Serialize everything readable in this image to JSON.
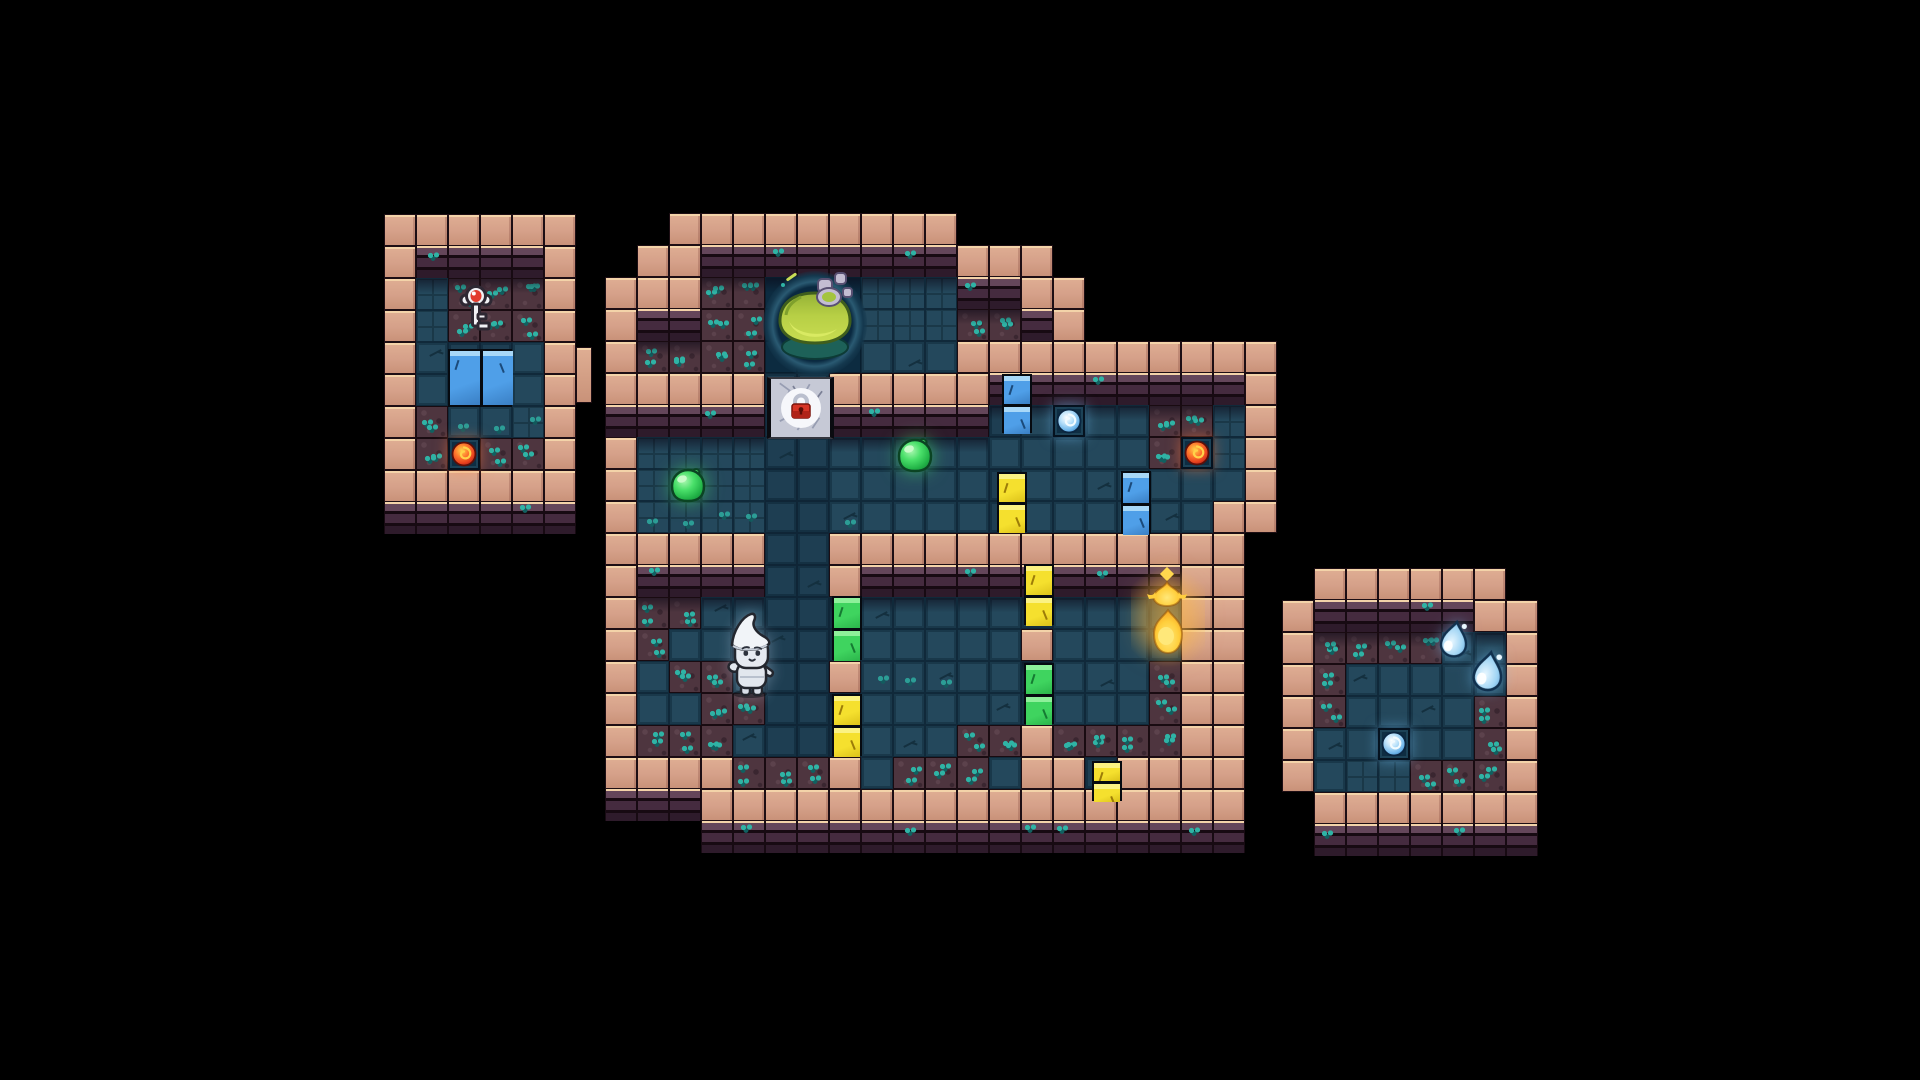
{
  "app": {
    "name": "pixel-dungeon-map",
    "view": "top-down dungeon floor on black void"
  },
  "scene": {
    "width": 1920,
    "height": 1080,
    "tile_size": 32,
    "background": "#000000",
    "palette": {
      "wall_pink": "#d5a089",
      "wall_pink_highlight": "#f3d3a9",
      "wall_seam": "#1d0e14",
      "brick_light": "#64465a",
      "brick_mid": "#452b3f",
      "brick_dark": "#2e1b2b",
      "brick_mortar": "#170a12",
      "floor": "#24485c",
      "floor_dark": "#1e3e52",
      "floor_line": "#1a3848",
      "dirt": "#4e353f",
      "moss": "#2fb3a5",
      "moss_dark": "#116060",
      "pit": "#0c2b40",
      "pit_ring": "#2a5a72",
      "goo": "#b7cf45",
      "goo_light": "#d9ea62",
      "goo_dark": "#3f5e1d",
      "slime_green": "#35d355",
      "orb_red": "#e8431f",
      "orb_blue": "#7cc3f0",
      "door_blue": "#4f9fe8",
      "door_yellow": "#f5e02e",
      "door_green": "#3fd45f",
      "stone_door": "#c6c9d6",
      "lock_red": "#d63426",
      "flame_gold": "#ffb12a",
      "water_blue": "#9fd4f4",
      "player_white": "#e8ecf2"
    },
    "legend": {
      "P": "pink-wall",
      "B": "brick-wall-face",
      "F": "floor-tile",
      "S": "floor-small-tiles",
      "f": "floor-dark",
      "D": "dirt-floor",
      "C": "pit-floor",
      ".": "void"
    },
    "structures": [
      {
        "id": "west-room",
        "origin": [
          384,
          214
        ],
        "rows": [
          "PPPPPP",
          "PBBBBP",
          "PSDDDP",
          "PSDDDP",
          "PFffFP",
          "PFffFP",
          "PDFFSP",
          "PDFDDP",
          "PPPPPP",
          "BBBBBB"
        ]
      },
      {
        "id": "main-dungeon",
        "origin": [
          605,
          213
        ],
        "rows": [
          "..PPPPPPPPP..........",
          ".PPBBBBBBBBPPP.......",
          "PPPDDCCCSSSBBPP......",
          "PBBDDCCCSSSDDBP......",
          "PDDDDCCCFFFPPPPPPPPPP",
          "PPPPPffPPPPPBBBBBBBBP",
          "BBBBBffBBBBBfFFFFDDSP",
          "PSSSSffFFFFFFFFFFDFSP",
          "PSSSSffFFFFFfFFFFFFFP",
          "PSSSSffFFFFFfFFFFFFPP",
          "PPPPPffPPPPPPPPPPPPP.",
          "PBBBBffPBBBBBBBBBBPP.",
          "PDDFFfffFFFFFfFFFfPP.",
          "PDFFFfffFFFFFPFFFfPP.",
          "PFDDFffPFFFFFfFFFDPP.",
          "PFFDDfffFFFFFfFFFDPP.",
          "PDDDFfffFFFDDPDDDDPP.",
          "PPPPDDDPFDDDFPPfPPPP.",
          "BBBPPPPPPPPPPPPPPPPP.",
          "...BBBBBBBBBBBBBBBBB."
        ]
      },
      {
        "id": "east-room",
        "origin": [
          1282,
          568
        ],
        "rows": [
          ".PPPPPP.",
          "PBBBBBPP",
          "PDDDDFFP",
          "PDFFFFFP",
          "PDFFFFDP",
          "PFFFFFDP",
          "PFSSDDDP",
          ".PPPPPPP",
          ".BBBBBBB"
        ]
      }
    ],
    "entities": [
      {
        "name": "silver-key",
        "type": "key",
        "x": 456,
        "y": 283,
        "w": 40,
        "h": 52
      },
      {
        "name": "west-room-blue-door",
        "type": "door",
        "color": "blue",
        "orient": "wide",
        "x": 448,
        "y": 349,
        "w": 64,
        "h": 58
      },
      {
        "name": "west-room-red-orb",
        "type": "orb",
        "color": "red",
        "x": 448,
        "y": 438,
        "w": 32,
        "h": 32
      },
      {
        "name": "west-room-wall-buttress",
        "type": "wall-block",
        "x": 576,
        "y": 347,
        "w": 16,
        "h": 56
      },
      {
        "name": "cauldron-pool",
        "type": "cauldron",
        "x": 763,
        "y": 271,
        "w": 104,
        "h": 106
      },
      {
        "name": "locked-stone-door",
        "type": "locked-door",
        "x": 767,
        "y": 377,
        "w": 67,
        "h": 62
      },
      {
        "name": "green-slime-west",
        "type": "slime",
        "color": "green",
        "x": 666,
        "y": 466,
        "w": 44,
        "h": 40
      },
      {
        "name": "green-slime-east",
        "type": "slime",
        "color": "green",
        "x": 893,
        "y": 436,
        "w": 44,
        "h": 40
      },
      {
        "name": "blue-door-a",
        "type": "door",
        "color": "blue",
        "orient": "tall",
        "x": 1002,
        "y": 374,
        "w": 30,
        "h": 59
      },
      {
        "name": "yellow-door-a",
        "type": "door",
        "color": "yellow",
        "orient": "tall",
        "x": 997,
        "y": 472,
        "w": 30,
        "h": 60
      },
      {
        "name": "blue-orb-main",
        "type": "orb",
        "color": "blue",
        "x": 1053,
        "y": 405,
        "w": 32,
        "h": 32
      },
      {
        "name": "red-orb-main",
        "type": "orb",
        "color": "red",
        "x": 1181,
        "y": 437,
        "w": 32,
        "h": 32
      },
      {
        "name": "blue-door-b",
        "type": "door",
        "color": "blue",
        "orient": "tall",
        "x": 1121,
        "y": 471,
        "w": 30,
        "h": 63
      },
      {
        "name": "yellow-door-b",
        "type": "door",
        "color": "yellow",
        "orient": "tall",
        "x": 1024,
        "y": 564,
        "w": 30,
        "h": 61
      },
      {
        "name": "green-door-a",
        "type": "door",
        "color": "green",
        "orient": "tall",
        "x": 832,
        "y": 596,
        "w": 30,
        "h": 64
      },
      {
        "name": "green-door-b",
        "type": "door",
        "color": "green",
        "orient": "tall",
        "x": 1024,
        "y": 663,
        "w": 30,
        "h": 61
      },
      {
        "name": "yellow-door-c",
        "type": "door",
        "color": "yellow",
        "orient": "tall",
        "x": 832,
        "y": 694,
        "w": 30,
        "h": 62
      },
      {
        "name": "yellow-door-d",
        "type": "door",
        "color": "yellow",
        "orient": "tall",
        "x": 1092,
        "y": 761,
        "w": 30,
        "h": 40
      },
      {
        "name": "golden-flame",
        "type": "flame",
        "x": 1137,
        "y": 566,
        "w": 62,
        "h": 104
      },
      {
        "name": "player-character",
        "type": "player",
        "x": 720,
        "y": 611,
        "w": 62,
        "h": 88
      },
      {
        "name": "water-droplet-small",
        "type": "droplet",
        "x": 1437,
        "y": 618,
        "w": 36,
        "h": 42
      },
      {
        "name": "water-droplet-large",
        "type": "droplet",
        "x": 1468,
        "y": 648,
        "w": 42,
        "h": 46
      },
      {
        "name": "blue-orb-east-room",
        "type": "orb",
        "color": "blue",
        "x": 1378,
        "y": 728,
        "w": 32,
        "h": 32
      }
    ]
  }
}
